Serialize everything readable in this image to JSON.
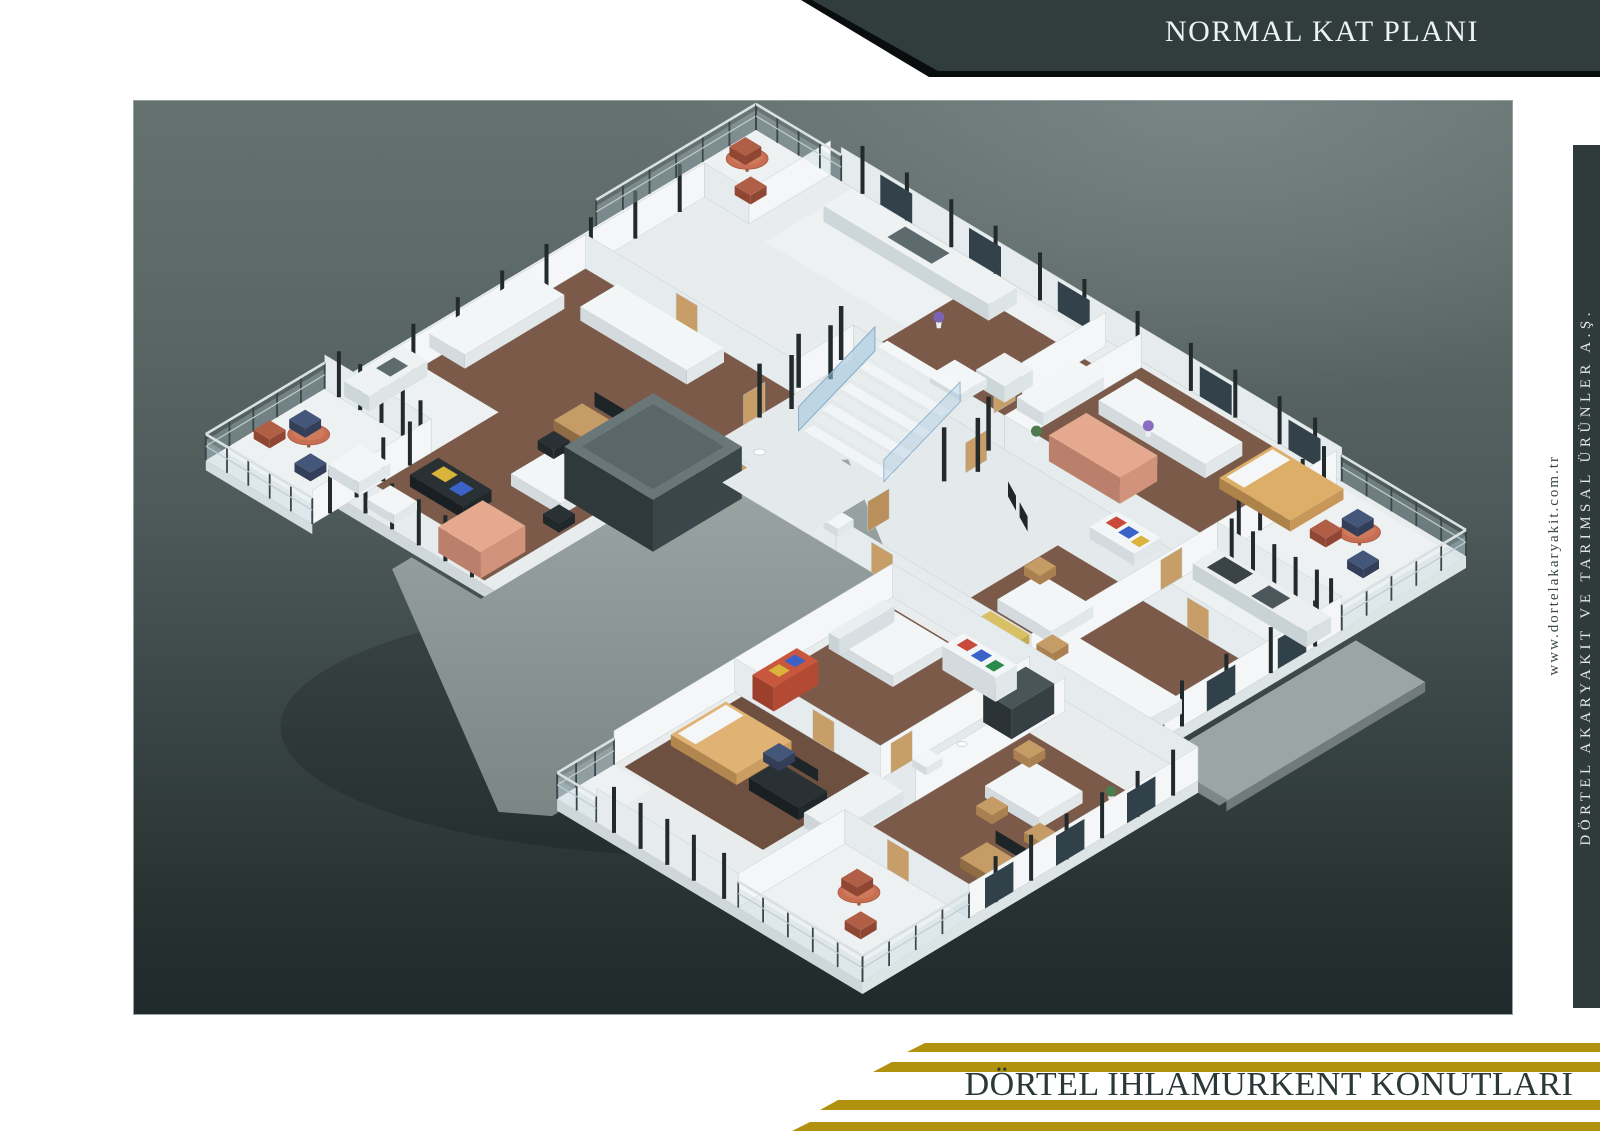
{
  "header": {
    "title": "NORMAL KAT PLANI"
  },
  "side": {
    "website": "www.dortelakaryakit.com.tr",
    "company": "DÖRTEL AKARYAKIT VE TARIMSAL ÜRÜNLER A.Ş."
  },
  "footer": {
    "title": "DÖRTEL IHLAMURKENT KONUTLARI"
  },
  "colors": {
    "gold": "#b0920f",
    "banner_bg": "#313c3d",
    "side_bar_bg": "#2f3a3b",
    "footer_text": "#2c3737",
    "panel_gradient_top": "#64716f",
    "panel_gradient_bottom": "#212a2b",
    "plan_wall": "#f3f6f7",
    "plan_wood_floor": "#7b5a49",
    "plan_roof": "#8f9a99",
    "plan_balcony_table": "#c86f53",
    "plan_accent_salmon": "#e5a98f"
  },
  "floor_plan": {
    "type": "isometric-3d-render",
    "elements": [
      "balcony-round-tables",
      "glass-railings",
      "staircase",
      "elevator-core",
      "kitchen-counters",
      "white-sofas",
      "wood-floors",
      "salmon-wardrobes",
      "roof-deck"
    ]
  }
}
